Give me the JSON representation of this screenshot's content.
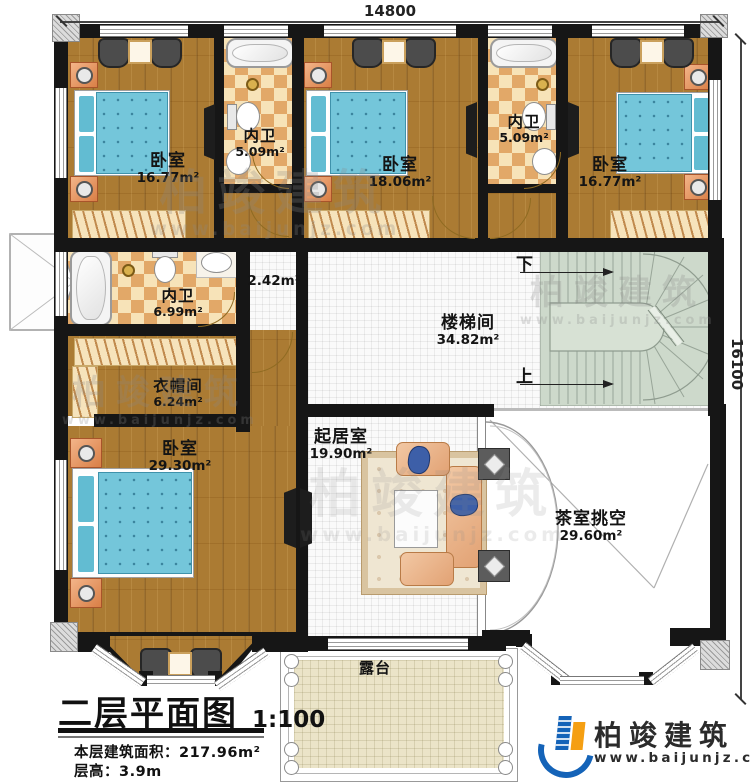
{
  "dimensions": {
    "width_mm": "14800",
    "depth_mm": "16100"
  },
  "rooms": {
    "bedroom_top_left": {
      "name": "卧室",
      "area": "16.77m²"
    },
    "bath_top_left": {
      "name": "内卫",
      "area": "5.09m²"
    },
    "bedroom_top_middle": {
      "name": "卧室",
      "area": "18.06m²"
    },
    "bath_top_right": {
      "name": "内卫",
      "area": "5.09m²"
    },
    "bedroom_top_right": {
      "name": "卧室",
      "area": "16.77m²"
    },
    "bath_middle": {
      "name": "内卫",
      "area": "6.99m²"
    },
    "hallway": {
      "area": "2.42m²"
    },
    "cloakroom": {
      "name": "衣帽间",
      "area": "6.24m²"
    },
    "bedroom_master": {
      "name": "卧室",
      "area": "29.30m²"
    },
    "living_room": {
      "name": "起居室",
      "area": "19.90m²"
    },
    "tea_room_void": {
      "name": "茶室挑空",
      "area": "29.60m²"
    },
    "terrace": {
      "name": "露台"
    }
  },
  "stairs": {
    "name": "楼梯间",
    "area": "34.82m²",
    "down": "下",
    "up": "上"
  },
  "title_block": {
    "title": "二层平面图",
    "scale": "1:100",
    "area_label": "本层建筑面积：",
    "area_value": "217.96m²",
    "height_label": "层高：",
    "height_value": "3.9m"
  },
  "brand": {
    "name": "柏竣建筑",
    "website": "www.baijunjz.com"
  },
  "watermark": {
    "name": "柏竣建筑",
    "website": "www.baijunjz.com"
  }
}
